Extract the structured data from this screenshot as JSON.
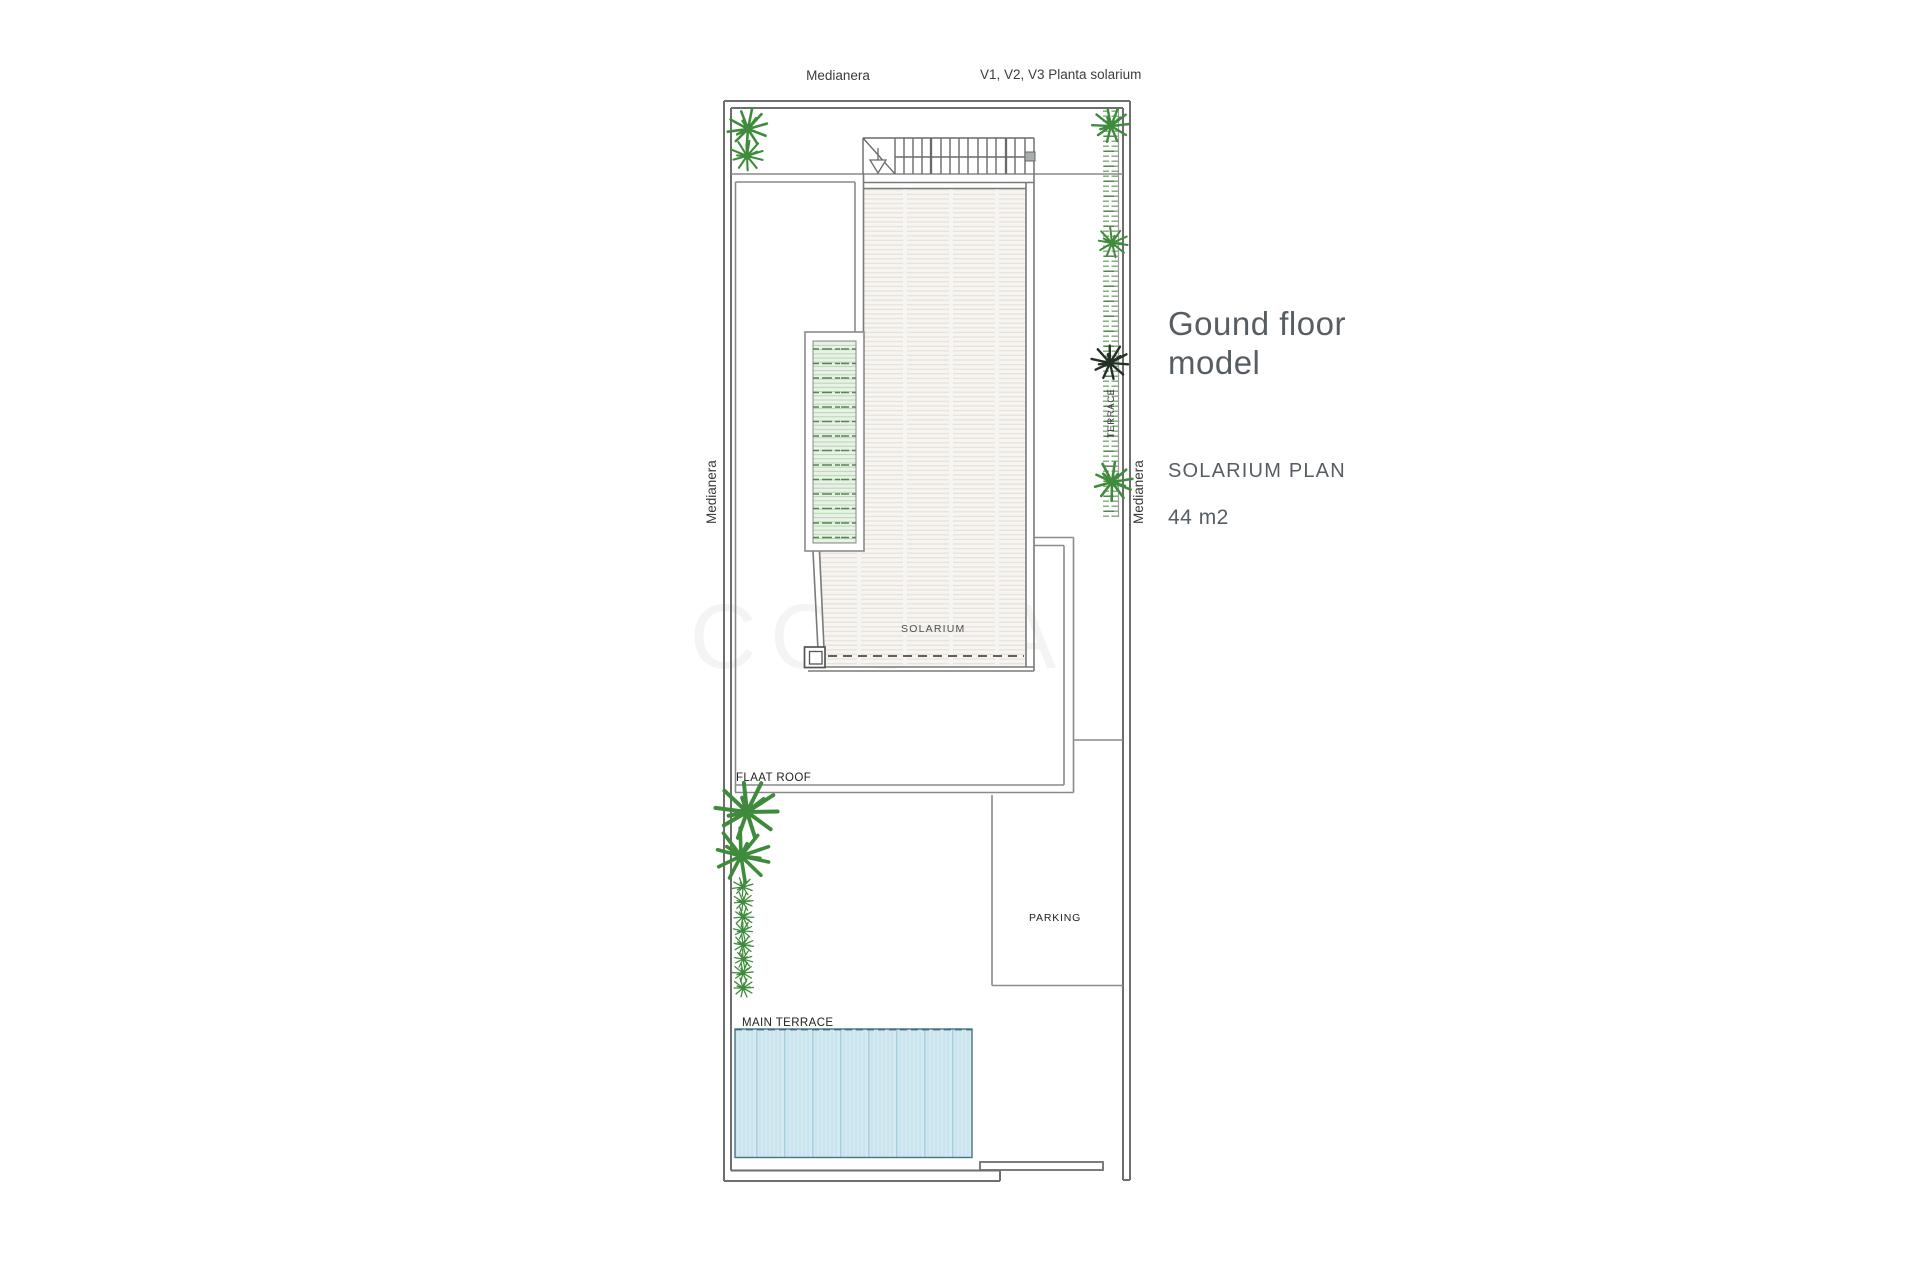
{
  "plan": {
    "labels": {
      "medianera_top": "Medianera",
      "version_note": "V1, V2, V3 Planta solarium",
      "medianera_left": "Medianera",
      "medianera_right": "Medianera",
      "terrace_side": "TERRACE",
      "solarium": "SOLARIUM",
      "flat_roof": "FLAAT ROOF",
      "parking": "PARKING",
      "main_terrace": "MAIN TERRACE",
      "watermark": "COSTA"
    },
    "colors": {
      "wall_line": "#6e6e6e",
      "thin_line": "#8a8a8a",
      "solarium_fill": "#f7f5f1",
      "solarium_stripe": "#e7e2d9",
      "planter_fill": "#e9f2e7",
      "planter_stripe": "#b9d6b5",
      "planter_dash": "#57854f",
      "right_strip_dash": "#7aa874",
      "plant_green": "#3f8b3c",
      "plant_dark": "#243024",
      "pool_fill": "#d4e9f1",
      "pool_stripe": "#c0e0ea",
      "pool_border": "#43707f",
      "label_text": "#2f2f2f",
      "side_text": "#565e64"
    }
  },
  "sidebar": {
    "title_line1": "Gound floor",
    "title_line2": "model",
    "plan_name": "SOLARIUM PLAN",
    "area": "44 m2"
  }
}
